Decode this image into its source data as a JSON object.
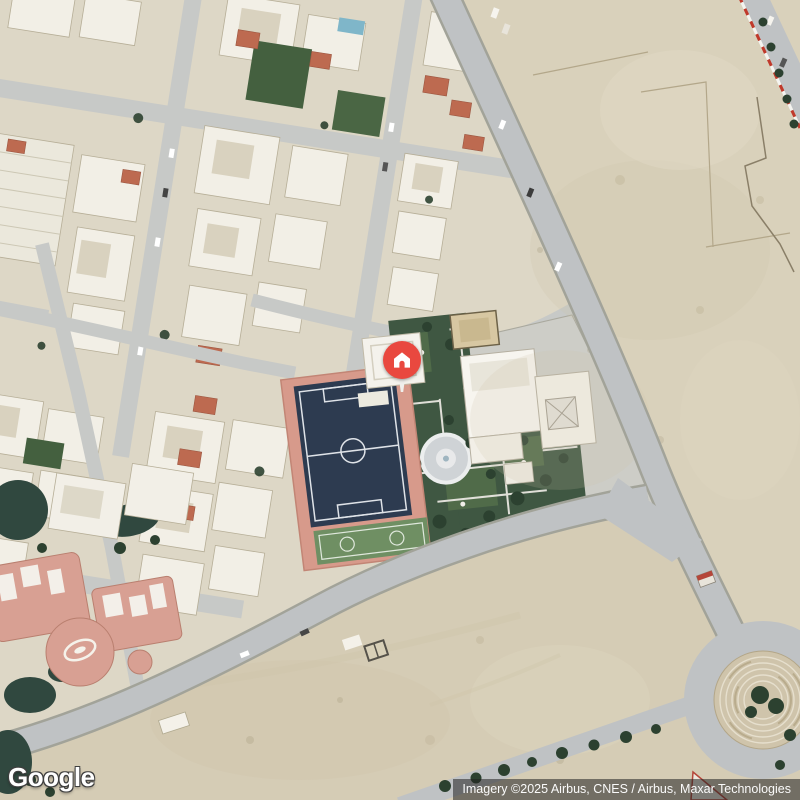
{
  "view": {
    "type": "satellite-map",
    "description": "aerial imagery of a desert residential district with a highlighted palace compound"
  },
  "branding": {
    "logo_text": "Google"
  },
  "attribution": {
    "text": "Imagery ©2025 Airbus, CNES / Airbus, Maxar Technologies"
  },
  "marker": {
    "kind": "property-home-marker",
    "icon": "home-icon",
    "color": "#e9483f"
  },
  "colors": {
    "marker_red": "#e9483f",
    "desert": "#d9d1bb",
    "desert_south": "#d5ccb5",
    "urban_ground": "#ddd7c6",
    "road": "#bfc2c4",
    "building_white": "#f2efe6",
    "soccer_field_navy": "#2d3b50",
    "court_green": "#6f8f63",
    "track_salmon": "#d79a8b",
    "garden_green": "#3f5742",
    "tree_dark": "#2c4130",
    "water_teal": "#30483f",
    "resort_pink": "#d8a093",
    "roundabout_tan": "#cfc4ab",
    "red_roof": "#bd6a50"
  },
  "map_features": [
    "residential-blocks",
    "soccer-field",
    "formal-garden",
    "fountain",
    "palace-compound",
    "desert-lots",
    "roundabout",
    "resort-complex",
    "main-roads",
    "side-streets"
  ]
}
